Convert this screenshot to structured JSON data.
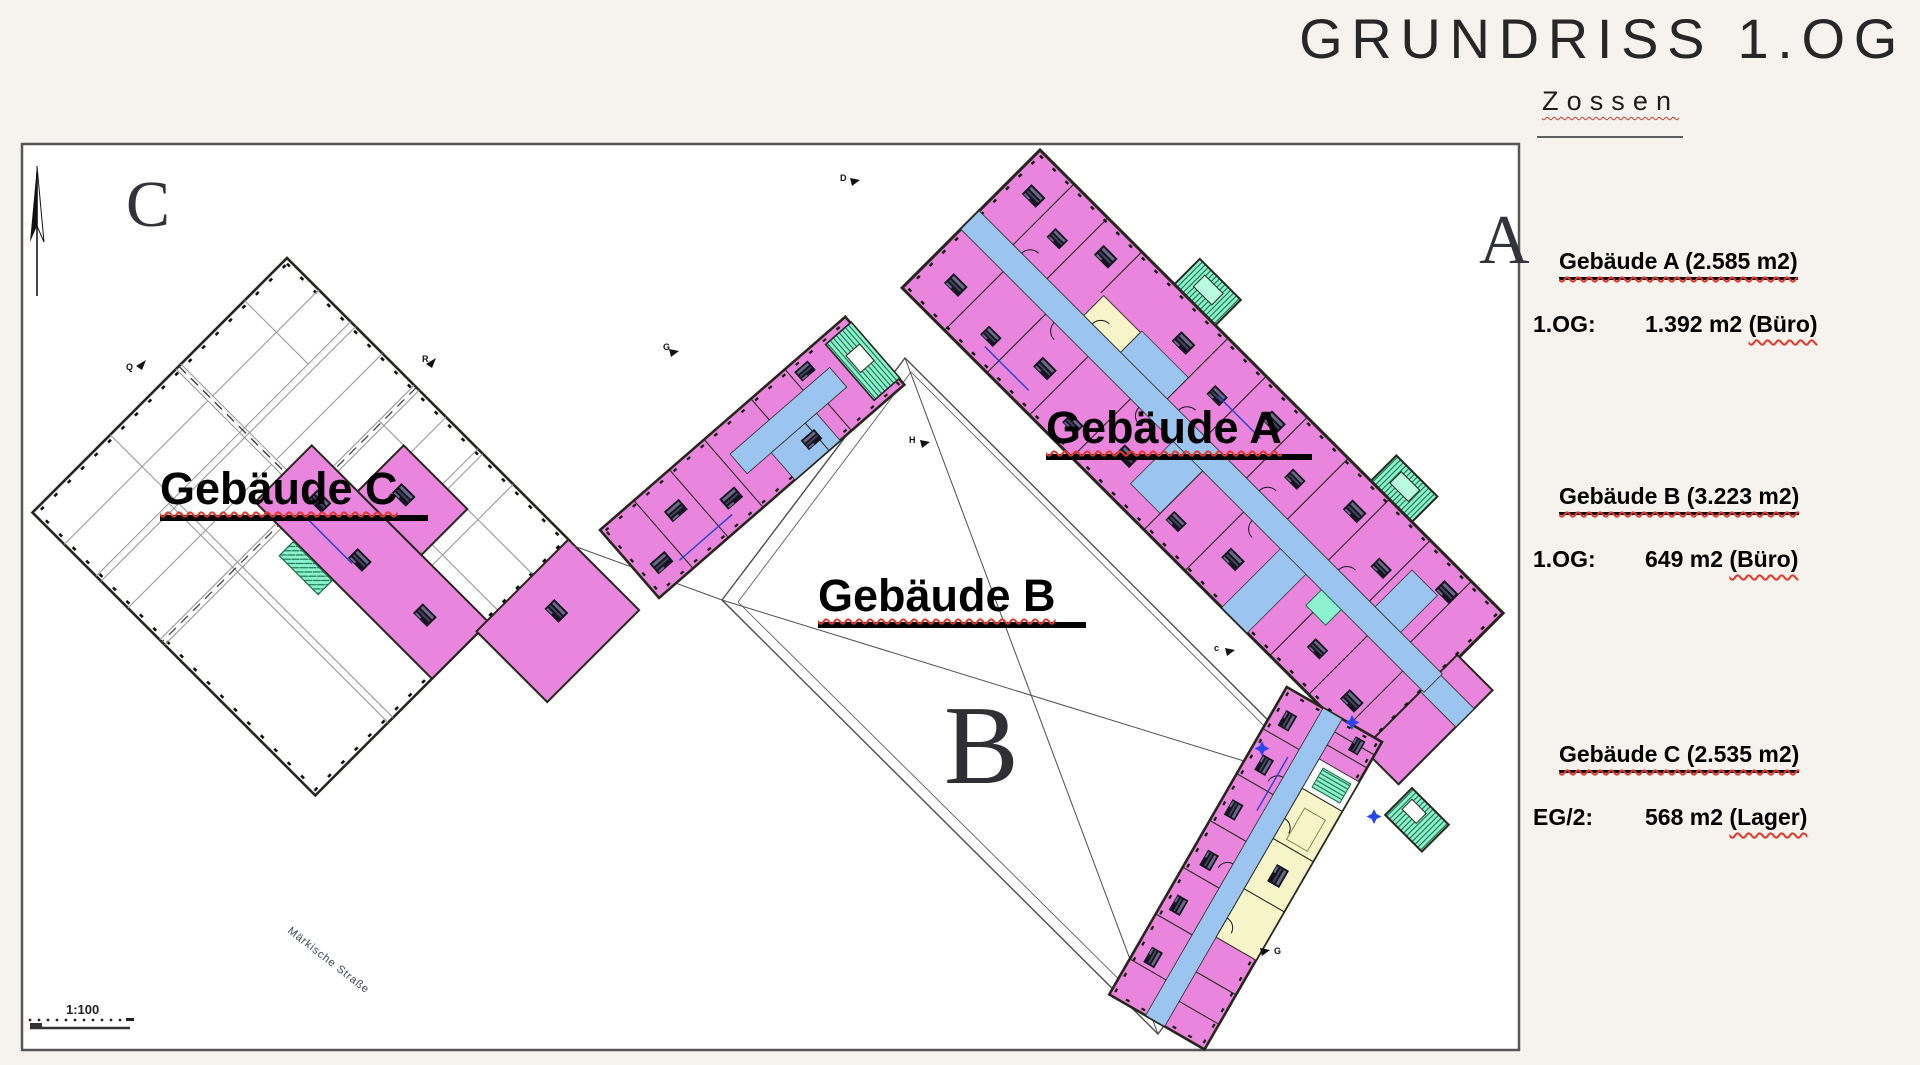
{
  "header": {
    "title": "GRUNDRISS 1.OG",
    "subtitle": "Zossen"
  },
  "legend": {
    "blocks": [
      {
        "heading": "Gebäude A (2.585 m2)",
        "floor": "1.OG:",
        "area": "1.392 m2",
        "note": "(Büro)"
      },
      {
        "heading": "Gebäude B (3.223 m2)",
        "floor": "1.OG:",
        "area": "649 m2",
        "note": "(Büro)"
      },
      {
        "heading": "Gebäude C (2.535 m2)",
        "floor": "EG/2:",
        "area": "568 m2",
        "note": "(Lager)"
      }
    ]
  },
  "plan": {
    "building_labels": {
      "a": "Gebäude A",
      "b": "Gebäude B",
      "c": "Gebäude C"
    },
    "block_letters": {
      "a": "A",
      "b": "B",
      "c": "C"
    },
    "section_marks": {
      "d": "D",
      "h": "H",
      "c1": "c",
      "g1": "G",
      "g2": "G",
      "q": "Q",
      "r": "R"
    },
    "street_label": "Märkische Straße",
    "scale_label": "1:100"
  },
  "colors": {
    "room_pink": "#ea85de",
    "corridor_blue": "#9cc4f0",
    "room_yellow": "#f7f4c9",
    "stair_teal": "#8df2cf",
    "outline_dark": "#26261c",
    "background": "#f6f2ee",
    "accent_red": "#d6392c"
  }
}
